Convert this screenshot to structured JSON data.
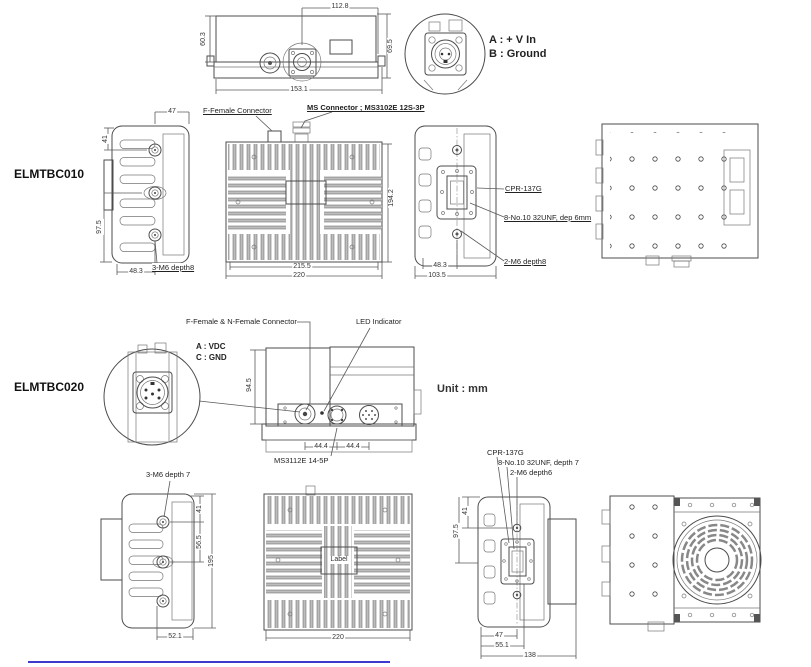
{
  "sheet": {
    "unit_note": "Unit : mm",
    "footer_rule_color": "#3b3bd0"
  },
  "p010": {
    "name": "ELMTBC010",
    "detail_note": {
      "a": "A : + V In",
      "b": "B : Ground"
    },
    "labels": {
      "f_female": "F-Female Connector",
      "ms_connector": "MS Connector ; MS3102E 12S-3P",
      "m6_3": "3-M6 depth8",
      "cpr": "CPR-137G",
      "unf": "8-No.10 32UNF, dep 6mm",
      "m6_2": "2-M6 depth8"
    },
    "dims": {
      "top_w": "112.8",
      "top_hl": "60.3",
      "top_hr": "69.5",
      "top_base": "153.1",
      "side_47": "47",
      "side_41": "41",
      "side_97_5": "97.5",
      "side_48_3": "48.3",
      "rear_215_5": "215.5",
      "rear_220": "220",
      "rear_194_2": "194.2",
      "right_48_3": "48.3",
      "right_103_5": "103.5"
    }
  },
  "p020": {
    "name": "ELMTBC020",
    "detail_note": {
      "a": "A : VDC",
      "c": "C : GND"
    },
    "labels": {
      "ffnf": "F-Female & N-Female Connector",
      "led": "LED Indicator",
      "ms_connector": "MS3112E 14-5P",
      "m6_3": "3-M6 depth 7",
      "cpr": "CPR-137G",
      "unf": "8-No.10 32UNF, depth 7",
      "m6_2": "2-M6 depth6",
      "label_plate": "Label"
    },
    "dims": {
      "top_94_5": "94.5",
      "top_44_4a": "44.4",
      "top_44_4b": "44.4",
      "side_41": "41",
      "side_56_5": "56.5",
      "side_195": "195",
      "side_52_1": "52.1",
      "rear_220": "220",
      "right_41": "41",
      "right_97_5": "97.5",
      "right_47": "47",
      "right_55_1": "55.1",
      "right_138": "138"
    }
  }
}
